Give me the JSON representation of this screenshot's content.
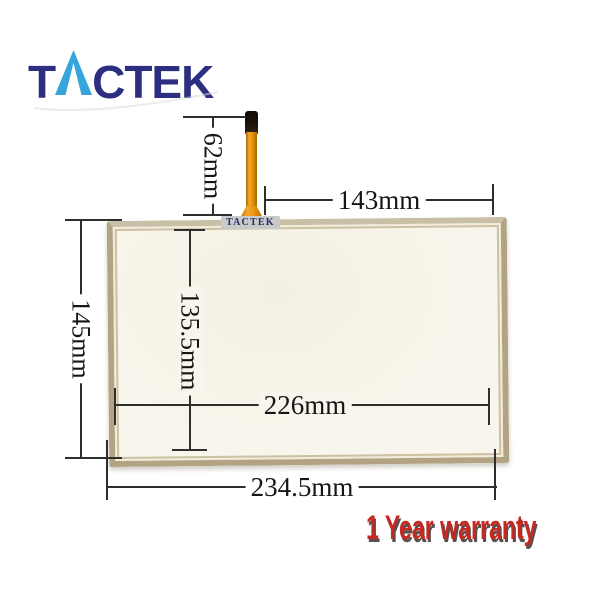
{
  "brand": {
    "name": "TACTEK",
    "logo_prefix": "T",
    "logo_suffix": "CTEK"
  },
  "panel": {
    "watermark": "TACTEK"
  },
  "dimensions": {
    "cable_length": "62mm",
    "top_width": "143mm",
    "left_height": "145mm",
    "inner_height": "135.5mm",
    "inner_width": "226mm",
    "bottom_width": "234.5mm"
  },
  "warranty_text": "1 Year warranty",
  "icons": {
    "logo_a": "triangle-a-icon",
    "swoosh": "logo-swoosh-icon"
  },
  "colors": {
    "brand_navy": "#2c2e80",
    "brand_blue": "#36a5db",
    "warranty_red": "#c42922",
    "panel_border": "#b2a383",
    "panel_face": "#f8f5ec",
    "cable_amber": "#ea960f",
    "cable_tip": "#1d120b",
    "dim_line": "#2e2e2e",
    "watermark_bg": "#c9c9c9"
  }
}
